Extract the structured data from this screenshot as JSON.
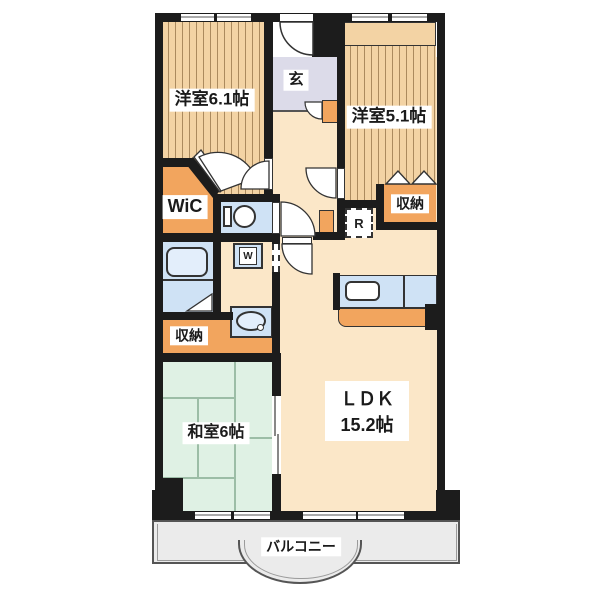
{
  "floorplan": {
    "rooms": {
      "west_room_1": "洋室6.1帖",
      "west_room_2": "洋室5.1帖",
      "entrance": "玄",
      "walk_in_closet": "WiC",
      "storage_upper": "収納",
      "storage_lower": "収納",
      "japanese_room": "和室6帖",
      "ldk_label": "ＬＤＫ",
      "ldk_size": "15.2帖",
      "balcony": "バルコニー"
    },
    "fixtures": {
      "refrigerator": "R",
      "washing_machine": "W"
    },
    "colors": {
      "wall": "#1c1c1c",
      "wood": "#f3d3a4",
      "wood_line": "#ab8a5e",
      "floor": "#fbe7c8",
      "genkan": "#dcdbe9",
      "accent_orange": "#f2a55e",
      "fixture_blue": "#cfe2f5",
      "fixture_blue_light": "#e3eefb",
      "tatami": "#dff1e4",
      "tatami_line": "#9cbda6",
      "balcony": "#ebebeb",
      "outline": "#333333"
    }
  }
}
